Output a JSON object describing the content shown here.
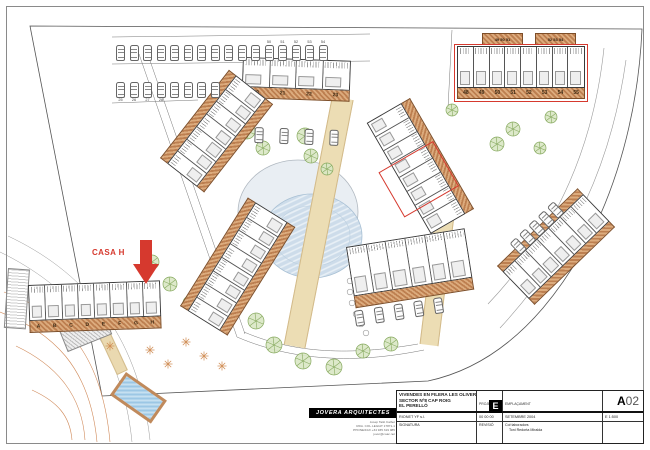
{
  "casa_callout": {
    "label": "CASA H"
  },
  "blocks": {
    "top_center": {
      "units": [
        "20",
        "21",
        "22",
        "23"
      ]
    },
    "top_right": {
      "units": [
        "48",
        "49",
        "50",
        "51",
        "52",
        "53",
        "54",
        "55"
      ]
    },
    "garage_strips": [
      "49 50 51",
      "52 53 54"
    ],
    "left_upper": {
      "units": [
        "",
        "",
        "",
        "",
        "",
        "",
        ""
      ]
    },
    "left_lower": {
      "units": [
        "",
        "",
        "",
        "",
        "",
        "",
        "",
        ""
      ]
    },
    "mid_right": {
      "units": [
        "",
        "",
        "",
        "",
        "",
        "",
        "",
        ""
      ]
    },
    "right_lower": {
      "units": [
        "",
        "",
        "",
        "",
        "",
        "",
        ""
      ]
    },
    "bottom_center": {
      "units": [
        "",
        "",
        "",
        "",
        "",
        ""
      ]
    },
    "letters": {
      "units": [
        "A",
        "B",
        "C",
        "D",
        "E",
        "F",
        "G",
        "H"
      ]
    }
  },
  "parking": {
    "row1_labels": [
      "",
      "",
      "",
      "",
      "",
      "",
      "",
      "",
      "",
      "",
      "",
      "50",
      "51",
      "52",
      "53",
      "54"
    ],
    "row2_labels": [
      "25",
      "26",
      "27",
      "28",
      "",
      "",
      "",
      ""
    ]
  },
  "title_block": {
    "project_line1": "VIVENDES EN FILERA LES OLIVERES",
    "project_line2": "SECTOR Nº8 CAP ROIG",
    "project_line3": "EL PERELLÓ",
    "col_projecte_label": "PROJECTE",
    "col_emplacament_label": "EMPLAÇAMENT",
    "badge_letter": "E",
    "promoter": "RIONET YF s.l.",
    "date_code": "00 00 00",
    "date_text": "SETEMBRE 2004",
    "signatura_label": "SIGNATURA",
    "revisio_label": "REVISIÓ",
    "collab_label": "Col·laboradors",
    "collab_name": "Toni Redorta Miralda",
    "sheet_letter": "A",
    "sheet_number": "02",
    "scale_text": "E 1:500"
  },
  "logo": {
    "name": "JOVERA ARQUITECTES",
    "lines": [
      "Josep Tailó Calbet",
      "RDA. COL·LEGIAT 17871-1",
      "PHONE/FAX +34 935 319 085",
      "jover@coac.net"
    ]
  }
}
